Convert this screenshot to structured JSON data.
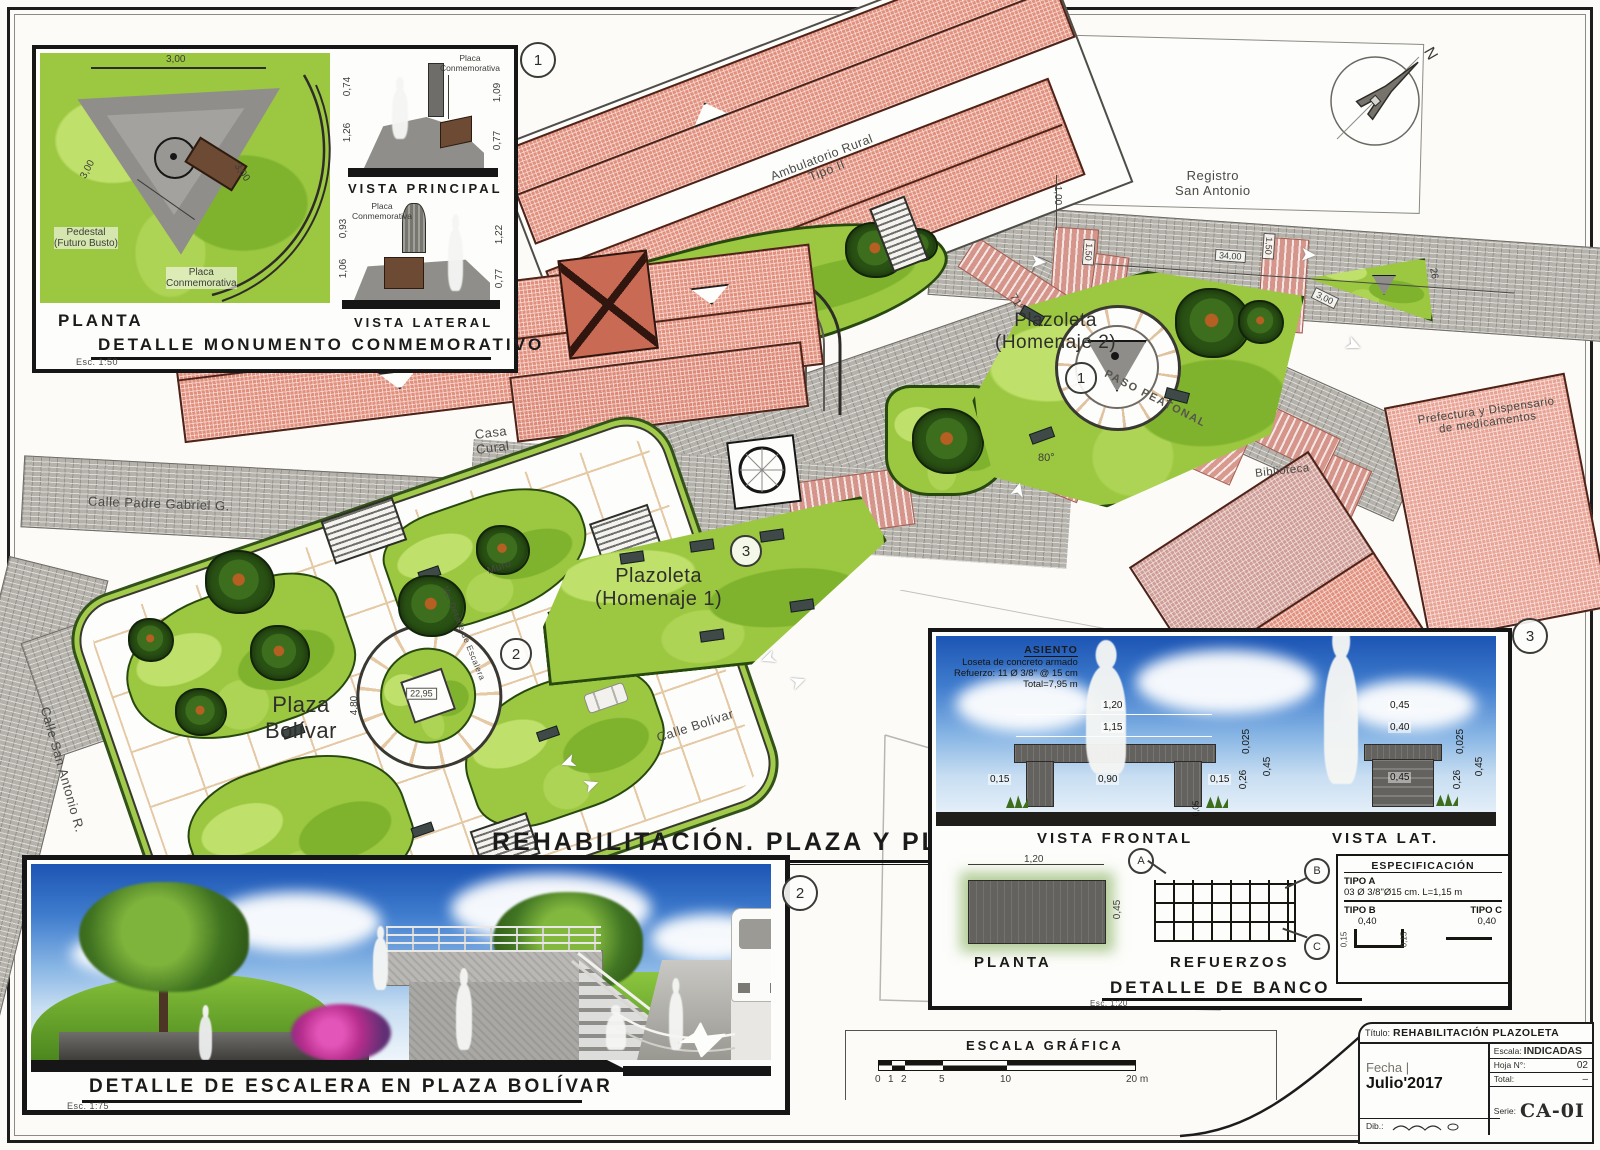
{
  "sheet_title": {
    "text": "REHABILITACIÓN. PLAZA Y PLAZOLETAS",
    "scale": "Esc. 1:200"
  },
  "plan": {
    "streets": {
      "padre_gabriel": "Calle Padre Gabriel G.",
      "san_antonio": "Calle San Antonio R.",
      "bolivar": "Calle Bolívar",
      "paso_peatonal": "PASO PEATONAL"
    },
    "places": {
      "plaza_1": "Plaza",
      "plaza_2": "Bolívar",
      "homenaje1_1": "Plazoleta",
      "homenaje1_2": "(Homenaje 1)",
      "homenaje2_1": "Plazoleta",
      "homenaje2_2": "(Homenaje 2)"
    },
    "buildings": {
      "ambulatorio_1": "Ambulatorio Rural",
      "ambulatorio_2": "Tipo II",
      "casa_cural_1": "Casa",
      "casa_cural_2": "Cural",
      "iglesia": "Iglesia",
      "registro_1": "Registro",
      "registro_2": "San Antonio",
      "prefectura_1": "Prefectura y Dispensario",
      "prefectura_2": "de medicamentos",
      "biblioteca": "Biblioteca"
    },
    "annotations": {
      "muro": "Muro",
      "ver_detalle": "Ver Detalle de Escalera",
      "north": "N",
      "dim_34": "34,00",
      "dim_3": "3,00",
      "dim_1": "1,00",
      "dim_150": "1,50",
      "ang_80": "80°",
      "ang_71": "71°",
      "dim_26": "26",
      "dim_2295": "22,95",
      "dim_480": "4,80"
    },
    "markers": {
      "m1": "1",
      "m2": "2",
      "m3": "3"
    }
  },
  "monument_panel": {
    "marker": "1",
    "title": "DETALLE MONUMENTO CONMEMORATIVO",
    "scale": "Esc. 1:50",
    "planta": {
      "caption": "PLANTA",
      "dim_top": "3,00",
      "dim_left": "3,00",
      "dim_right": "3,00",
      "pedestal_1": "Pedestal",
      "pedestal_2": "(Futuro Busto)",
      "placa_1": "Placa",
      "placa_2": "Conmemorativa"
    },
    "principal": {
      "caption": "VISTA PRINCIPAL",
      "placa_1": "Placa",
      "placa_2": "Conmemorativa",
      "d1": "0,74",
      "d2": "1,26",
      "d3": "1,09",
      "d4": "0,77"
    },
    "lateral": {
      "caption": "VISTA LATERAL",
      "placa_1": "Placa",
      "placa_2": "Conmemorativa",
      "d1": "0,93",
      "d2": "1,06",
      "d3": "1,22",
      "d4": "0,77"
    }
  },
  "stair_panel": {
    "marker": "2",
    "title": "DETALLE DE ESCALERA EN PLAZA BOLÍVAR",
    "scale": "Esc. 1:75"
  },
  "bench_panel": {
    "marker": "3",
    "title": "DETALLE DE BANCO",
    "scale": "Esc. 1:20",
    "asiento": {
      "t1": "ASIENTO",
      "t2": "Loseta de concreto armado",
      "t3": "Refuerzo: 11 Ø 3/8\" @ 15 cm",
      "t4": "Total=7,95 m"
    },
    "frontal": {
      "caption": "VISTA FRONTAL",
      "d120": "1,20",
      "d115": "1,15",
      "d090": "0,90",
      "d015a": "0,15",
      "d015b": "0,15",
      "d0025": "0,025",
      "d026": "0,26",
      "d045": "0,45",
      "d005": "0,05"
    },
    "lateral": {
      "caption": "VISTA LAT.",
      "d045a": "0,45",
      "d040": "0,40",
      "d045b": "0,45",
      "d0025": "0,025",
      "d026": "0,26",
      "d045c": "0,45"
    },
    "planta": {
      "caption": "PLANTA",
      "d120": "1,20",
      "d045": "0,45"
    },
    "refuerzos": {
      "caption": "REFUERZOS",
      "a": "A",
      "b": "B",
      "c": "C"
    },
    "espec": {
      "title": "ESPECIFICACIÓN",
      "tipo_a": "TIPO A",
      "tipo_a_val": "03 Ø 3/8\"Ø15 cm. L=1,15 m",
      "tipo_b": "TIPO B",
      "tipo_c": "TIPO C",
      "b040": "0,40",
      "c040": "0,40",
      "b015a": "0,15",
      "b015b": "0,15"
    }
  },
  "scale_bar": {
    "title": "ESCALA GRÁFICA",
    "t0": "0",
    "t1": "1",
    "t2": "2",
    "t5": "5",
    "t10": "10",
    "t20": "20 m"
  },
  "title_block": {
    "titulo_label": "Título:",
    "titulo": "REHABILITACIÓN PLAZOLETA",
    "fecha_label": "Fecha |",
    "fecha": "Julio'2017",
    "escala_label": "Escala:",
    "escala": "INDICADAS",
    "hoja_label": "Hoja N°:",
    "hoja": "02",
    "total_label": "Total:",
    "total": "–",
    "serie_label": "Serie:",
    "serie": "CA-0I",
    "dib_label": "Dib.:"
  }
}
